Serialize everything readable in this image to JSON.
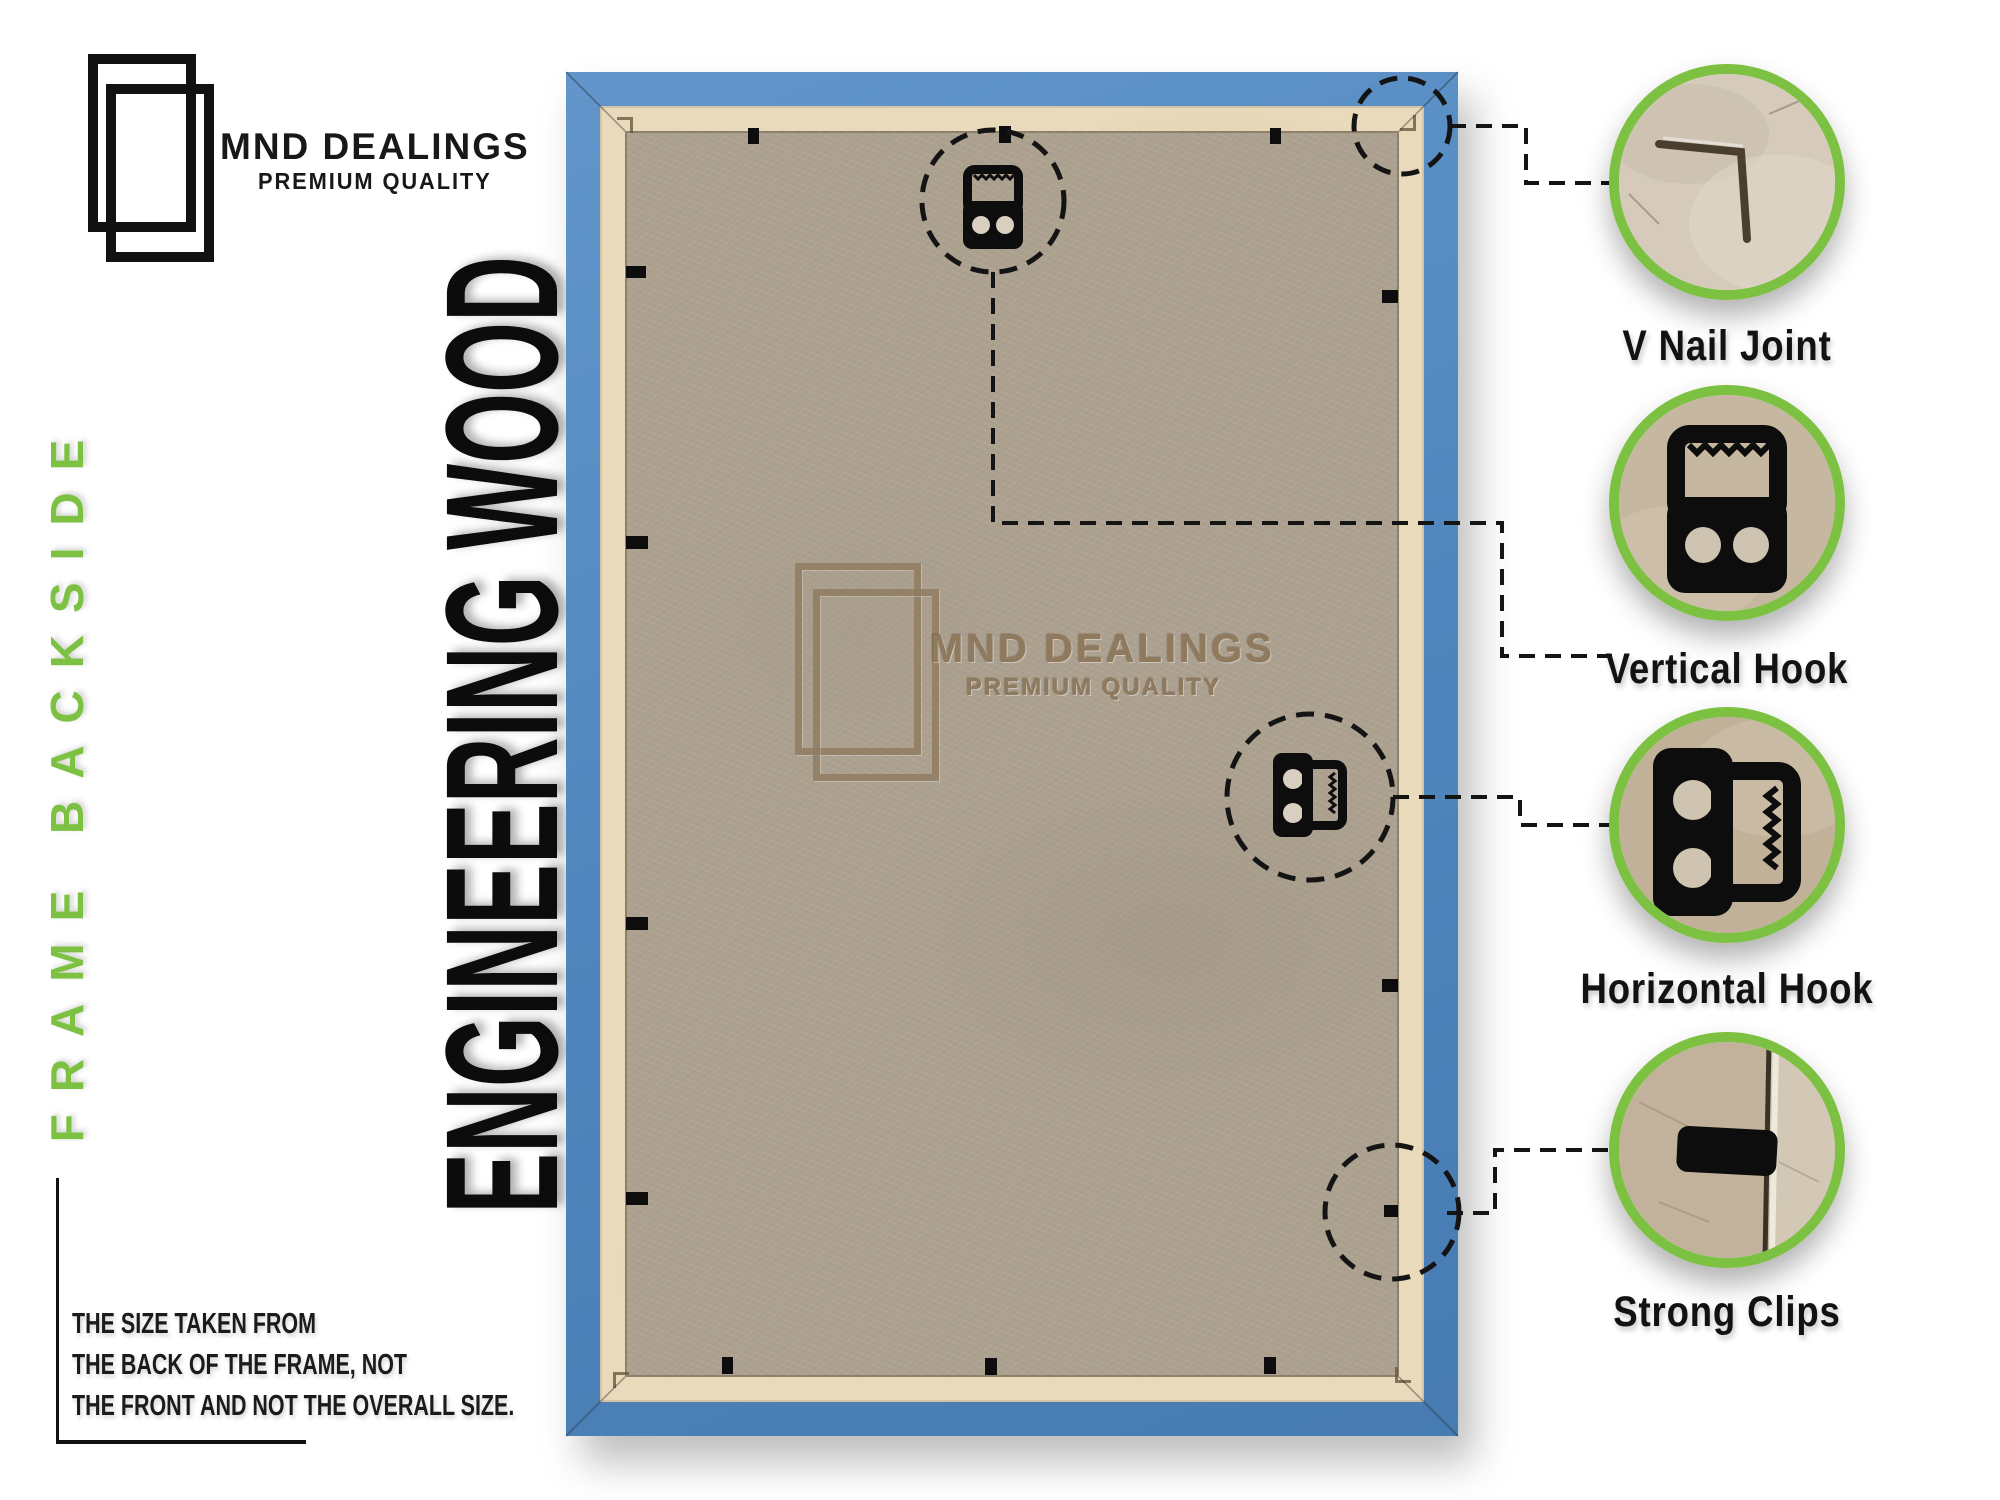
{
  "brand": {
    "name": "MND DEALINGS",
    "tagline": "PREMIUM QUALITY"
  },
  "left_panel": {
    "side_text": "FRAME BACKSIDE",
    "material_text": "ENGINEERING WOOD",
    "note_lines": [
      "THE SIZE TAKEN FROM",
      "THE BACK OF THE FRAME, NOT",
      "THE FRONT AND NOT THE OVERALL SIZE."
    ]
  },
  "watermark": {
    "name": "MND DEALINGS",
    "tagline": "PREMIUM QUALITY"
  },
  "callouts": {
    "v_nail": {
      "label": "V Nail Joint"
    },
    "vertical_hook": {
      "label": "Vertical Hook"
    },
    "horizontal_hook": {
      "label": "Horizontal Hook"
    },
    "strong_clips": {
      "label": "Strong Clips"
    }
  },
  "colors": {
    "accent_green": "#7dc142",
    "frame_blue": "#4e85bc",
    "wood_strip": "#e9dabc",
    "panel_board": "#aca08f",
    "watermark_brown": "#8f7a5e",
    "ink": "#141414"
  }
}
